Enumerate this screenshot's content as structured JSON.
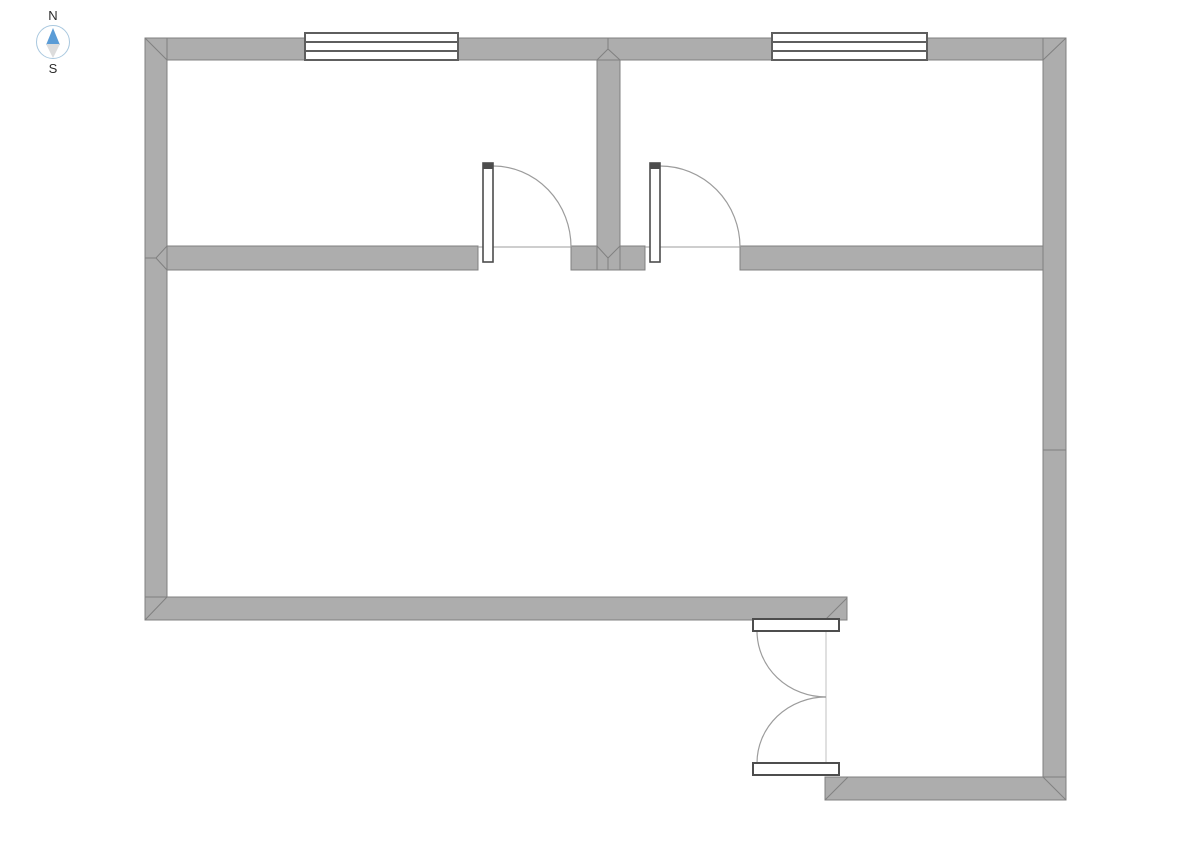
{
  "page": {
    "background": "#ffffff"
  },
  "compass": {
    "north_label": "N",
    "south_label": "S",
    "ring_color": "#a9c8df",
    "north_needle_color": "#5b9cd6",
    "south_needle_color": "#dcdcdc",
    "label_color": "#2b2b2b"
  },
  "colors": {
    "wall_fill": "#adadad",
    "wall_stroke": "#808080",
    "window_fill": "#ffffff",
    "window_stroke": "#5e5e5e",
    "door_leaf_fill": "#ffffff",
    "door_leaf_stroke": "#4d4d4d",
    "door_arc": "#9c9c9c",
    "opening_line": "#9c9c9c",
    "track_line": "#c0c0c0"
  },
  "plan": {
    "canvas": {
      "width": 1190,
      "height": 841
    },
    "walls": [
      {
        "name": "wall-top",
        "x": 145,
        "y": 38,
        "w": 921,
        "h": 22
      },
      {
        "name": "wall-left",
        "x": 145,
        "y": 38,
        "w": 22,
        "h": 582
      },
      {
        "name": "wall-right",
        "x": 1043,
        "y": 38,
        "w": 23,
        "h": 762
      },
      {
        "name": "wall-divider-top-rooms",
        "x": 597,
        "y": 60,
        "w": 23,
        "h": 210
      },
      {
        "name": "wall-middle-left",
        "x": 167,
        "y": 246,
        "w": 311,
        "h": 24
      },
      {
        "name": "wall-middle-center-left",
        "x": 571,
        "y": 246,
        "w": 26,
        "h": 24
      },
      {
        "name": "wall-middle-center-right",
        "x": 620,
        "y": 246,
        "w": 25,
        "h": 24
      },
      {
        "name": "wall-middle-right",
        "x": 740,
        "y": 246,
        "w": 303,
        "h": 24
      },
      {
        "name": "wall-bottom-main",
        "x": 145,
        "y": 597,
        "w": 702,
        "h": 23
      },
      {
        "name": "wall-bottom-entry",
        "x": 825,
        "y": 777,
        "w": 241,
        "h": 23
      }
    ],
    "joint_lines": [
      {
        "x1": 145,
        "y1": 38,
        "x2": 167,
        "y2": 60
      },
      {
        "x1": 1066,
        "y1": 38,
        "x2": 1043,
        "y2": 60
      },
      {
        "x1": 597,
        "y1": 60,
        "x2": 608,
        "y2": 49
      },
      {
        "x1": 608,
        "y1": 49,
        "x2": 620,
        "y2": 60
      },
      {
        "x1": 608,
        "y1": 38,
        "x2": 608,
        "y2": 49
      },
      {
        "x1": 167,
        "y1": 246,
        "x2": 156,
        "y2": 258
      },
      {
        "x1": 156,
        "y1": 258,
        "x2": 167,
        "y2": 270
      },
      {
        "x1": 145,
        "y1": 258,
        "x2": 156,
        "y2": 258
      },
      {
        "x1": 597,
        "y1": 246,
        "x2": 608,
        "y2": 258
      },
      {
        "x1": 620,
        "y1": 246,
        "x2": 608,
        "y2": 258
      },
      {
        "x1": 608,
        "y1": 258,
        "x2": 608,
        "y2": 270
      },
      {
        "x1": 145,
        "y1": 620,
        "x2": 167,
        "y2": 597
      },
      {
        "x1": 825,
        "y1": 620,
        "x2": 847,
        "y2": 598
      },
      {
        "x1": 825,
        "y1": 800,
        "x2": 848,
        "y2": 777
      },
      {
        "x1": 1043,
        "y1": 777,
        "x2": 1066,
        "y2": 800
      },
      {
        "x1": 1043,
        "y1": 450,
        "x2": 1066,
        "y2": 450
      }
    ],
    "windows": [
      {
        "name": "window-room-left",
        "x": 305,
        "y": 33,
        "w": 153,
        "h": 27
      },
      {
        "name": "window-room-right",
        "x": 772,
        "y": 33,
        "w": 155,
        "h": 27
      }
    ],
    "interior_doors": [
      {
        "name": "door-room-left",
        "leaf": {
          "x": 483,
          "y": 163,
          "w": 10,
          "h": 99
        },
        "arc": "M 493 166 A 78 81 0 0 1 571 247",
        "opening_line": {
          "x1": 478,
          "y1": 247,
          "x2": 571,
          "y2": 247
        }
      },
      {
        "name": "door-room-right",
        "leaf": {
          "x": 650,
          "y": 163,
          "w": 10,
          "h": 99
        },
        "arc": "M 660 166 A 80 81 0 0 1 740 247",
        "opening_line": {
          "x1": 645,
          "y1": 247,
          "x2": 740,
          "y2": 247
        }
      }
    ],
    "entry_doors": {
      "name": "entry-double-door",
      "leaves": [
        {
          "name": "entry-door-leaf-inner",
          "x": 753,
          "y": 619,
          "w": 86,
          "h": 12
        },
        {
          "name": "entry-door-leaf-outer",
          "x": 753,
          "y": 763,
          "w": 86,
          "h": 12
        }
      ],
      "arcs": [
        "M 757 631 A 69 66 0 0 0 826 697",
        "M 757 763 A 69 66 0 0 1 826 697"
      ],
      "track_line": {
        "x1": 826,
        "y1": 631,
        "x2": 826,
        "y2": 763
      }
    }
  }
}
